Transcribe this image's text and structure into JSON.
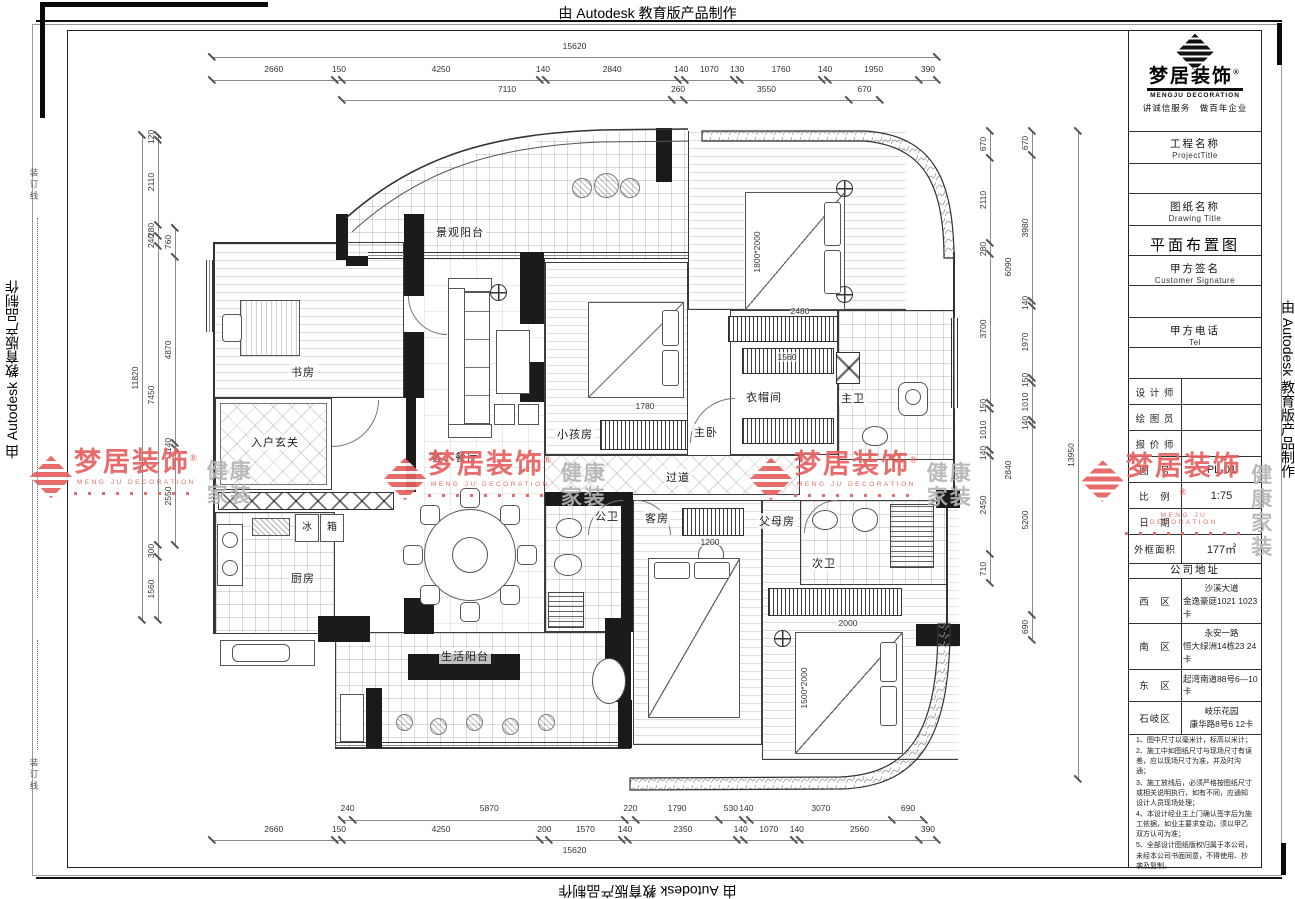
{
  "banner": {
    "top": "由 Autodesk 教育版产品制作",
    "left": "由 Autodesk 教育版产品制作",
    "right": "由 Autodesk 教育版产品制作",
    "bottom": "由 Autodesk 教育版产品制作"
  },
  "margin": {
    "binding_line": "装订线"
  },
  "title_block": {
    "brand": {
      "name": "梦居装饰",
      "reg": "®",
      "name_en": "MENGJU DECORATION",
      "slogan": "讲诚信服务　做百年企业"
    },
    "fields": [
      {
        "label": "工程名称",
        "sub": "ProjectTitle",
        "value": ""
      },
      {
        "label": "图纸名称",
        "sub": "Drawing Title",
        "value": "平面布置图"
      },
      {
        "label": "甲方签名",
        "sub": "Customer Signature",
        "value": ""
      },
      {
        "label": "甲方电话",
        "sub": "Tel",
        "value": ""
      }
    ],
    "rows": [
      {
        "label": "设 计 师",
        "value": ""
      },
      {
        "label": "绘 图 员",
        "value": ""
      },
      {
        "label": "报 价 师",
        "value": ""
      },
      {
        "label": "图　号",
        "value": "PL-01"
      },
      {
        "label": "比　例",
        "value": "1:75"
      },
      {
        "label": "日　期",
        "value": ""
      },
      {
        "label": "外框面积",
        "value": "177㎡"
      }
    ],
    "address_header": "公司地址",
    "addresses": [
      {
        "district": "西　区",
        "lines": [
          "沙溪大道",
          "金逸豪庭1021 1023卡"
        ]
      },
      {
        "district": "南　区",
        "lines": [
          "永安一路",
          "恒大绿洲14栋23 24卡"
        ]
      },
      {
        "district": "东　区",
        "lines": [
          "起湾南道88号6—10卡"
        ]
      },
      {
        "district": "石岐区",
        "lines": [
          "岐乐花园",
          "康华路8号6 12卡"
        ]
      }
    ],
    "notes": [
      "1、图中尺寸以毫米计，标高以米计；",
      "2、施工中如图纸尺寸与现场尺寸有误差，应以现场尺寸为准，并及时沟通；",
      "3、施工放线后，必须严格按图纸尺寸或相关说明执行，如有不同，应通知设计人员现场处理；",
      "4、本设计经业主上门确认签字后为施工依据，如业主要求变动，须以甲乙双方认可为准；",
      "5、全部设计图纸版权归属于本公司，未经本公司书面同意，不得使用、抄袭及复制。"
    ]
  },
  "watermark": {
    "brand": "梦居装饰",
    "reg": "®",
    "brand_en": "MENG JU DECORATION",
    "tag1": "健康",
    "tag2": "家装",
    "red": "#e86060",
    "gray": "#b5b5b5"
  },
  "plan": {
    "rooms": {
      "balcony_top": {
        "label": "景观阳台"
      },
      "study": {
        "label": "书房"
      },
      "foyer": {
        "label": "入户玄关"
      },
      "living_dining": {
        "label": "客、餐厅"
      },
      "kids_room": {
        "label": "小孩房"
      },
      "master_bed": {
        "label": "主卧"
      },
      "closet": {
        "label": "衣帽间"
      },
      "master_bath": {
        "label": "主卫"
      },
      "corridor": {
        "label": "过道"
      },
      "public_bath": {
        "label": "公卫"
      },
      "guest_room": {
        "label": "客房"
      },
      "parents_room": {
        "label": "父母房"
      },
      "second_bath": {
        "label": "次卫"
      },
      "kitchen": {
        "label": "厨房"
      },
      "balcony_bottom": {
        "label": "生活阳台"
      }
    },
    "fridge_left": "冰",
    "fridge_right": "箱",
    "interior_dims": [
      "2480",
      "1560",
      "1780",
      "1200",
      "2000",
      "1800*2000",
      "1500*2000"
    ]
  },
  "dimensions": {
    "top_total": [
      "15620"
    ],
    "top_row": [
      "2660",
      "150",
      "4250",
      "140",
      "2840",
      "140",
      "1070",
      "130",
      "1760",
      "140",
      "1950",
      "390"
    ],
    "top_row2": [
      "7110",
      "260",
      "3550",
      "670"
    ],
    "bottom_row1": [
      "240",
      "5870",
      "220",
      "1790",
      "530",
      "140",
      "3070",
      "690"
    ],
    "bottom_row": [
      "2660",
      "150",
      "4250",
      "200",
      "1570",
      "140",
      "2350",
      "140",
      "1070",
      "140",
      "2560",
      "390"
    ],
    "bottom_total": [
      "15620"
    ],
    "left_total": [
      "11820"
    ],
    "left_mid": [
      "120",
      "2110",
      "280",
      "240",
      "7450",
      "300",
      "1560"
    ],
    "left_inner": [
      "760",
      "4870",
      "140",
      "2550"
    ],
    "right_inner": [
      "670",
      "2110",
      "280",
      "3700",
      "150",
      "1010",
      "140",
      "2450",
      "710"
    ],
    "right_outer": [
      "670",
      "3980",
      "140",
      "1970",
      "150",
      "1010",
      "140",
      "5200",
      "690"
    ],
    "right_total": [
      "13950"
    ],
    "right_extra": [
      "6090",
      "2840"
    ]
  }
}
